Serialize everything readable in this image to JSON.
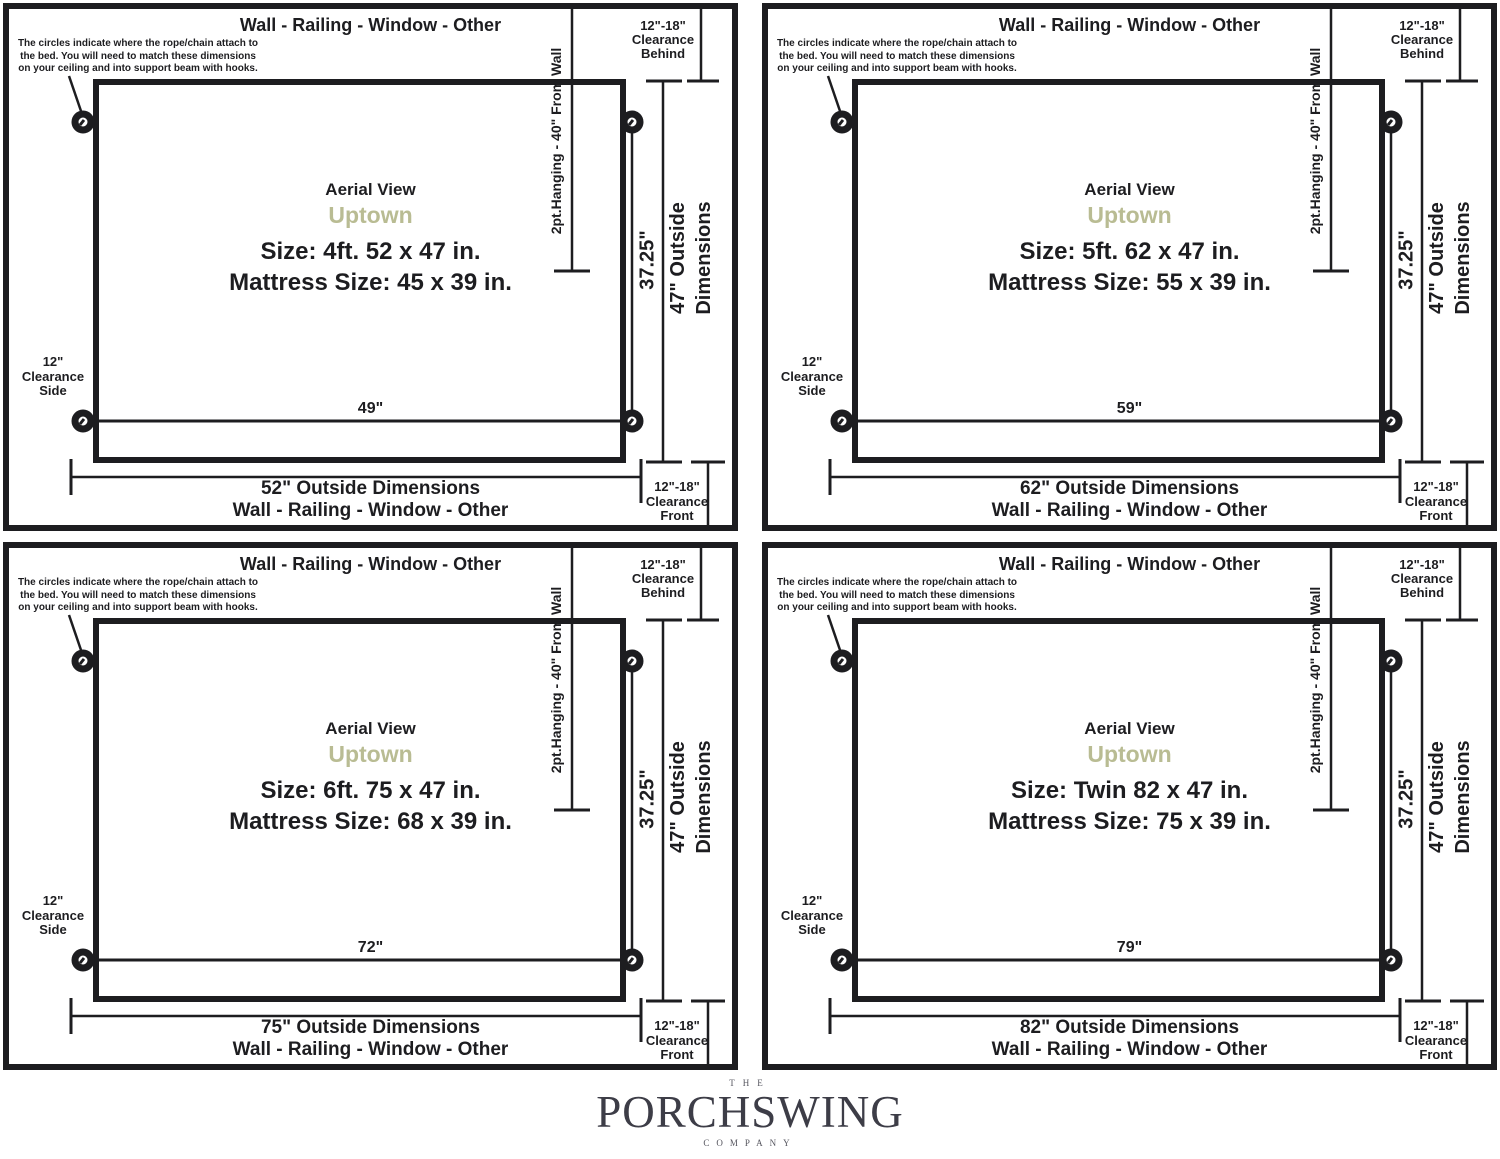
{
  "shared": {
    "wall_label": "Wall - Railing - Window - Other",
    "note": "The circles indicate where the rope/chain attach to\nthe bed. You will need to match these dimensions\non your ceiling and into support beam with hooks.",
    "hanging_label": "2pt.Hanging - 40\" From Wall",
    "clearance_behind": "12\"-18\"\nClearance\nBehind",
    "clearance_side": "12\"\nClearance\nSide",
    "clearance_front": "12\"-18\"\nClearance\nFront",
    "depth_label": "37.25\"",
    "outside_depth_label": "47\" Outside\nDimensions",
    "aerial_label": "Aerial View",
    "model_name": "Uptown"
  },
  "panels": [
    {
      "size_label": "Size: 4ft. 52 x 47 in.",
      "mattress_label": "Mattress Size: 45 x 39 in.",
      "inner_width": "49\"",
      "outside_width": "52\" Outside Dimensions"
    },
    {
      "size_label": "Size: 5ft. 62 x 47 in.",
      "mattress_label": "Mattress Size: 55 x 39 in.",
      "inner_width": "59\"",
      "outside_width": "62\" Outside Dimensions"
    },
    {
      "size_label": "Size: 6ft. 75 x 47 in.",
      "mattress_label": "Mattress Size: 68 x 39 in.",
      "inner_width": "72\"",
      "outside_width": "75\" Outside Dimensions"
    },
    {
      "size_label": "Size: Twin 82 x 47 in.",
      "mattress_label": "Mattress Size: 75 x 39 in.",
      "inner_width": "79\"",
      "outside_width": "82\" Outside Dimensions"
    }
  ],
  "logo": {
    "the": "THE",
    "name": "PORCHSWING",
    "company": "COMPANY"
  },
  "colors": {
    "ink": "#1d1d20",
    "accent": "#b9bc93",
    "logo_dark": "#3d3d47",
    "logo_light": "#55555e"
  }
}
